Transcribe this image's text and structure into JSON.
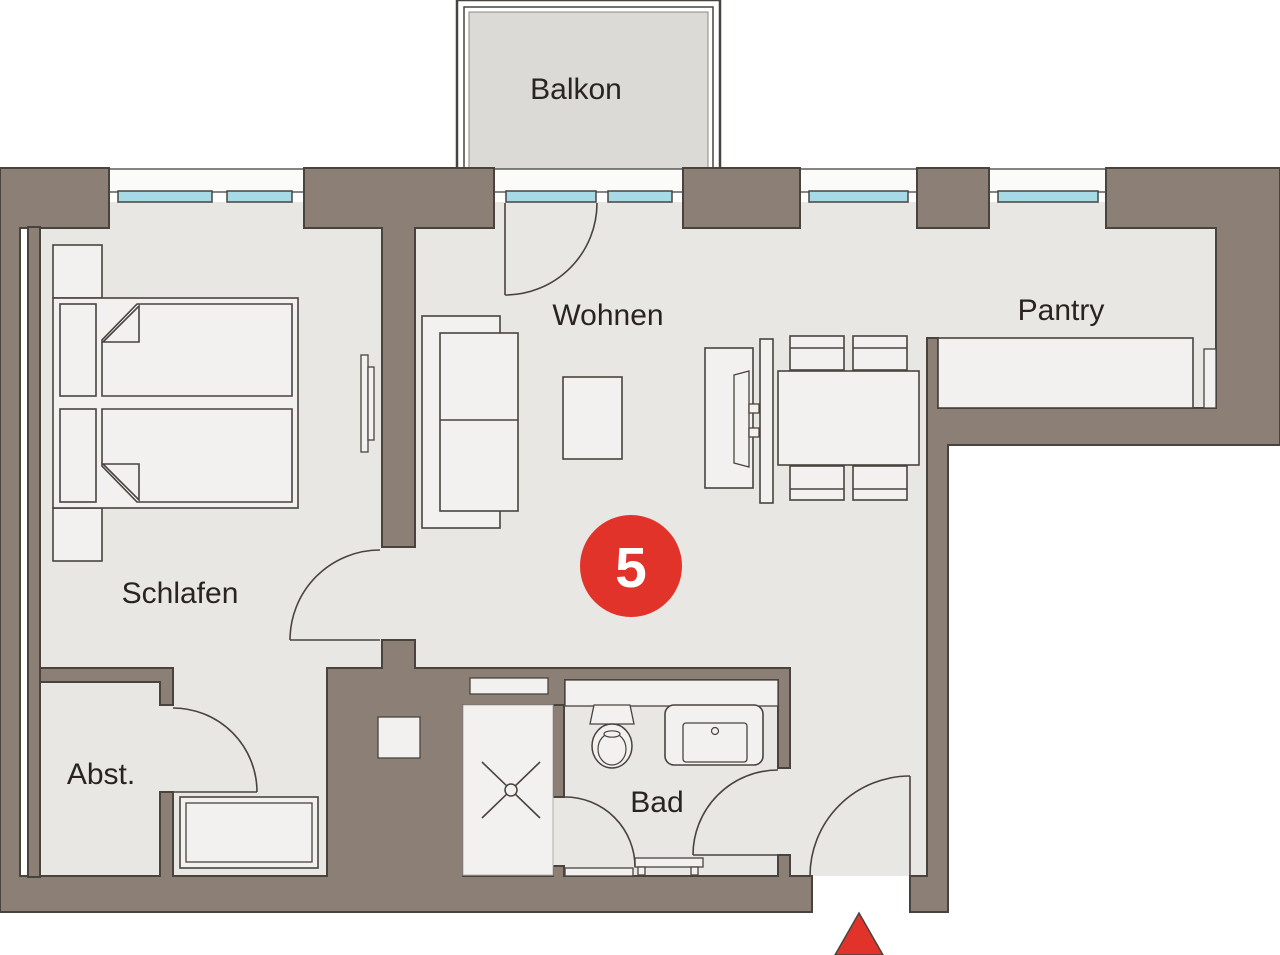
{
  "plan": {
    "title": "apartment-floor-plan",
    "unit_badge": {
      "number": "5",
      "color": "#e1332a"
    },
    "rooms": [
      {
        "id": "balkon",
        "label": "Balkon"
      },
      {
        "id": "wohnen",
        "label": "Wohnen"
      },
      {
        "id": "pantry",
        "label": "Pantry"
      },
      {
        "id": "schlafen",
        "label": "Schlafen"
      },
      {
        "id": "abstellraum",
        "label": "Abst."
      },
      {
        "id": "bad",
        "label": "Bad"
      }
    ],
    "colors": {
      "wall": "#8c7f75",
      "wall_outline": "#49433e",
      "floor": "#e9e7e4",
      "window_glass": "#a6dae6",
      "balcony_floor": "#dcdad7",
      "accent_red": "#e1332a",
      "text": "#282420"
    },
    "markers": {
      "entrance": "red-triangle-up"
    }
  }
}
